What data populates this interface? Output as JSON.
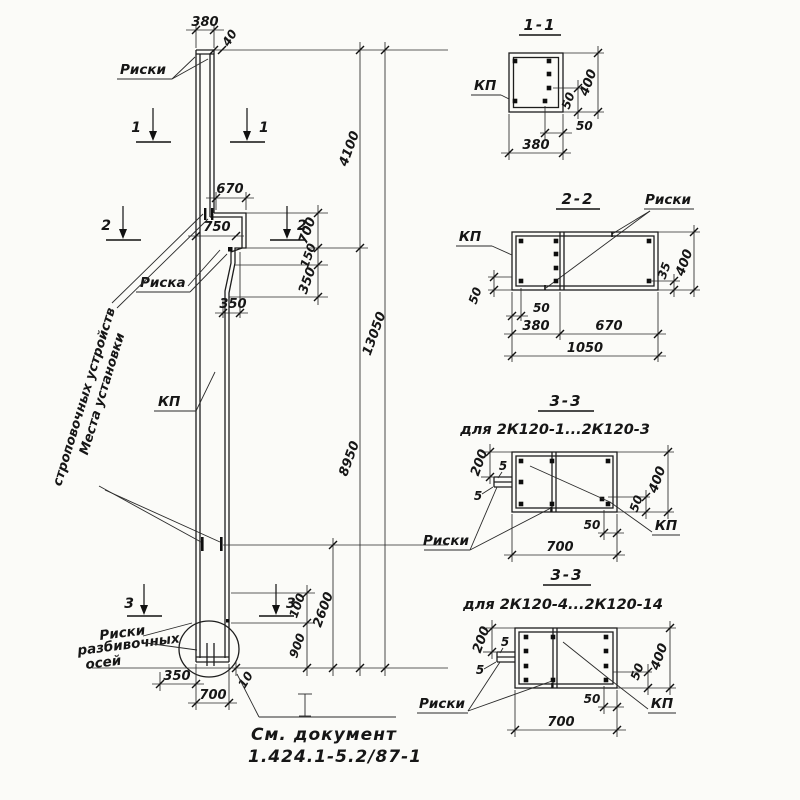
{
  "elevation": {
    "labels": {
      "riski_top": "Риски",
      "riska": "Риска",
      "kp": "КП",
      "mesta_line1": "Места установки",
      "mesta_line2": "строповочных устройств",
      "axes_line1": "Риски",
      "axes_line2": "разбивочных",
      "axes_line3": "осей",
      "mark_i": "I"
    },
    "section_marks": {
      "s1": "1",
      "s2": "2",
      "s3": "3"
    },
    "dims": {
      "top_width": "380",
      "top_offset": "40",
      "console_width": "670",
      "console_width2": "750",
      "console_slope": "350",
      "upper_height": "4100",
      "console_h1": "700",
      "console_h2": "150",
      "console_h3": "350",
      "total_height": "13050",
      "lower_height": "8950",
      "bottom_h1": "100",
      "bottom_h2": "900",
      "bottom_h3": "2600",
      "bottom_w1": "350",
      "bottom_w2": "700",
      "bottom_gap": "10"
    },
    "note": {
      "line1": "См. документ",
      "line2": "1.424.1-5.2/87-1"
    }
  },
  "sections": {
    "s11": {
      "title": "1-1",
      "kp": "КП",
      "width": "380",
      "bar_offset": "50",
      "height": "400",
      "side_offset": "50"
    },
    "s22": {
      "title": "2-2",
      "riski": "Риски",
      "kp": "КП",
      "left_offset": "50",
      "bar_offset": "50",
      "seg1": "380",
      "seg2": "670",
      "total": "1050",
      "right_offset": "35",
      "height": "400"
    },
    "s33a": {
      "title": "3-3",
      "subtitle": "для 2К120-1...2К120-3",
      "riski": "Риски",
      "kp": "КП",
      "top_offset": "200",
      "plate1": "5",
      "plate2": "5",
      "bar_offset": "50",
      "width": "700",
      "side_offset": "50",
      "height": "400"
    },
    "s33b": {
      "title": "3-3",
      "subtitle": "для 2К120-4...2К120-14",
      "riski": "Риски",
      "kp": "КП",
      "top_offset": "200",
      "plate1": "5",
      "plate2": "5",
      "bar_offset": "50",
      "width": "700",
      "side_offset": "50",
      "height": "400"
    }
  }
}
